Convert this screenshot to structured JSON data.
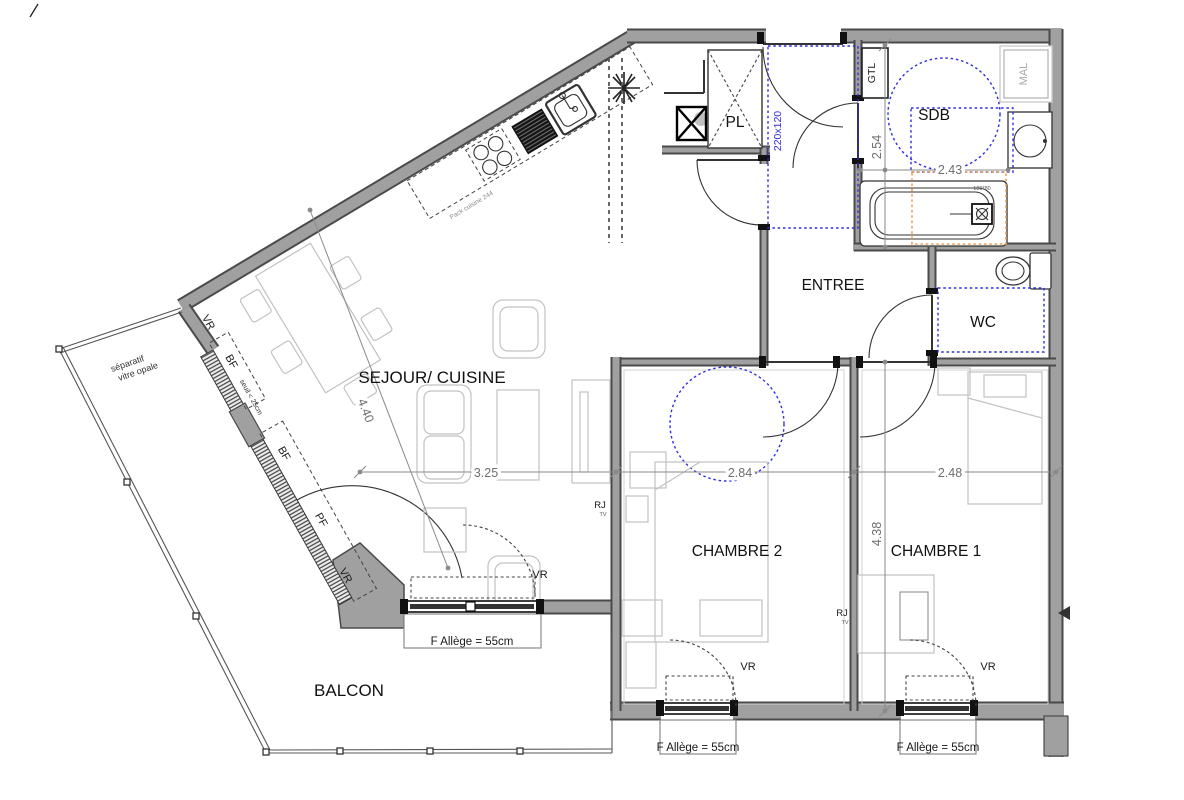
{
  "rooms": {
    "sejour_cuisine": "SEJOUR/ CUISINE",
    "balcon": "BALCON",
    "entree": "ENTREE",
    "chambre2": "CHAMBRE 2",
    "chambre1": "CHAMBRE 1",
    "sdb": "SDB",
    "wc": "WC",
    "placard": "PL"
  },
  "dimensions": {
    "sejour_diagonal": "4.40",
    "sejour_width": "3.25",
    "chambre2_width": "2.84",
    "chambre1_width": "2.48",
    "sdb_height": "2.54",
    "sdb_width": "2.43",
    "chambres_depth": "4.38"
  },
  "equipment": {
    "entry_door_size": "220x120",
    "gtl": "GTL",
    "mal": "MAL",
    "bathtub_size": "180*80",
    "rj_outlet": "RJ",
    "tv_outlet": "TV",
    "kitchen_pack": "Pack cuisine 244"
  },
  "window_labels": {
    "vr": "VR",
    "bf": "BF",
    "pf": "PF",
    "f_allege": "F  Allège = 55cm",
    "seuil": "seuil < 25cm",
    "separatif_line1": "séparatif",
    "separatif_line2": "vitre opale"
  },
  "colors": {
    "wall_fill": "#a0a0a0",
    "wall_edge": "#4a4a4a",
    "accessibility_blue": "#2d2de0",
    "bathtub_zone_orange": "#f0a050",
    "dimension_gray": "#8a8a8a",
    "furniture_gray": "#c4c4c4"
  }
}
